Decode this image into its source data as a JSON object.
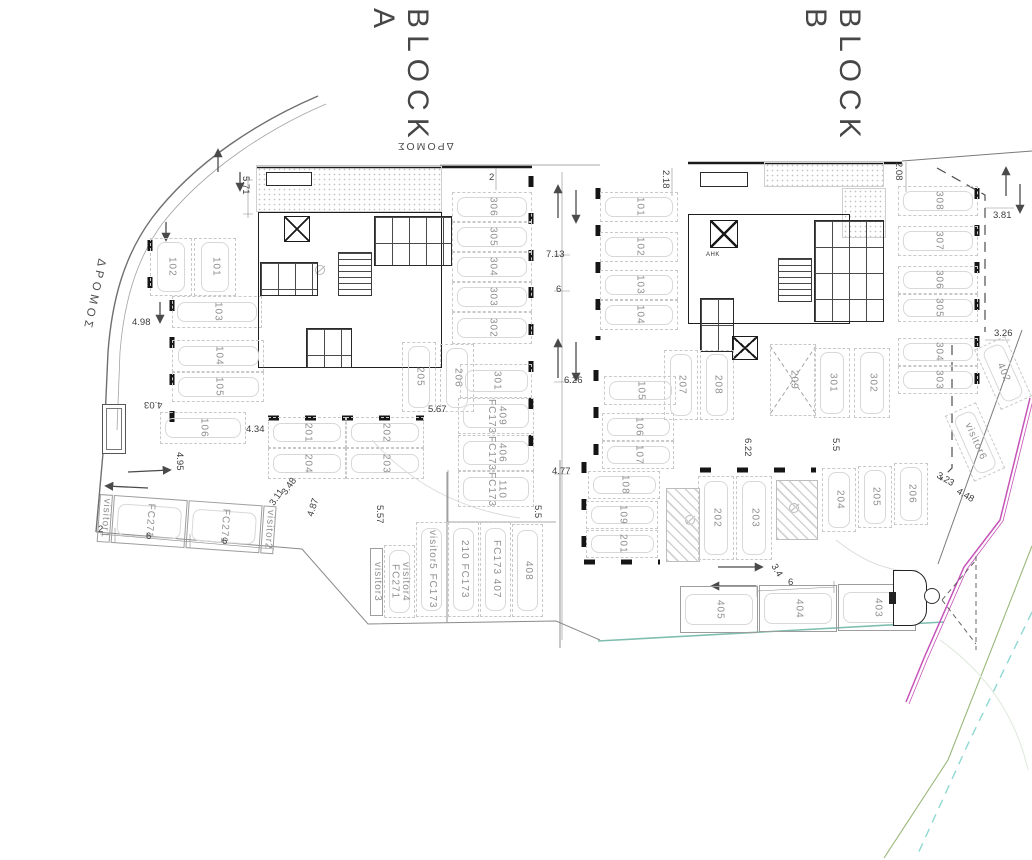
{
  "titles": {
    "block_a": "BLOCK A",
    "block_b": "BLOCK B"
  },
  "road": {
    "left": "ΔΡΟΜΟΣ",
    "top": "ΔΡΟΜΟΣ"
  },
  "core": {
    "ahk": "ΑΗΚ"
  },
  "colors": {
    "boundary_magenta": "#c653b8",
    "line_green": "#9ab87a",
    "line_cyan_dashed": "#8fd8d2",
    "line_teal": "#7fbfb0",
    "plan_dark": "#1b1b1b",
    "faint_gray": "#c9c9c9"
  },
  "a": {
    "left_pair": [
      "102",
      "101"
    ],
    "left_col": [
      "103",
      "104",
      "105",
      "106"
    ],
    "mid_r1": [
      "201",
      "202"
    ],
    "mid_r2": [
      "204",
      "203"
    ],
    "pair_56": [
      "205",
      "206"
    ],
    "right_col": [
      "306",
      "305",
      "304",
      "303",
      "302",
      "301"
    ],
    "fc_col": [
      "409 FC173",
      "406 FC173",
      "110 FC173"
    ],
    "bl_row": [
      "visitor1",
      "FC271",
      "FC271",
      "visitor2"
    ],
    "bc_row": [
      "visitor3",
      "visitor4 FC271",
      "visitor5 FC173",
      "210 FC173",
      "FC173 407",
      "408"
    ]
  },
  "b": {
    "left_col": [
      "101",
      "102",
      "103",
      "104"
    ],
    "left_col2": [
      "105",
      "106",
      "107",
      "108",
      "109",
      "201"
    ],
    "pair_78": [
      "207",
      "208"
    ],
    "x209": "209",
    "pair_3012": [
      "301",
      "302"
    ],
    "pair_2023": [
      "202",
      "203"
    ],
    "trio": [
      "204",
      "205",
      "206"
    ],
    "right_col": [
      "308",
      "307",
      "306",
      "305",
      "304",
      "303"
    ],
    "bottom_row": [
      "405",
      "404",
      "403"
    ],
    "angled": [
      "402",
      "visitor6"
    ]
  },
  "dims": {
    "d571": "5.71",
    "d498": "4.98",
    "d403": "4.03",
    "d434": "4.34",
    "d495": "4.95",
    "d348": "3.48",
    "d311": "3.11",
    "d487": "4.87",
    "d557": "5.57",
    "d567": "5.67",
    "d2a": "2",
    "d6a": "6",
    "d6b": "6",
    "d2b": "2",
    "d713": "7.13",
    "d6c": "6",
    "d626": "6.26",
    "d477": "4.77",
    "d55a": "5.5",
    "d55b": "5.5",
    "d622": "6.22",
    "d218": "2.18",
    "d208": "2.08",
    "d381": "3.81",
    "d326": "3.26",
    "d323": "3.23",
    "d448": "4.48",
    "d34": "3.4",
    "d6d": "6"
  }
}
